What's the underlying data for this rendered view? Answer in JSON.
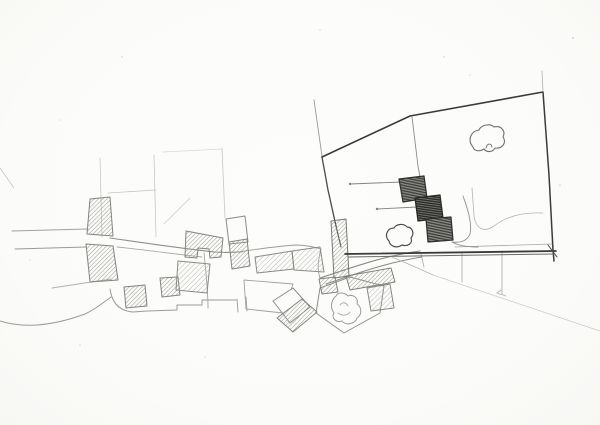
{
  "meta": {
    "description": "Hand-drawn pencil site plan sketch: a village of hatched buildings along a curving street on the left, and on the right a large plot outlined in dark pencil containing three dark stepped buildings, two trees and a bush, with faint construction lines, parcel boundaries and slope lines below."
  },
  "palette": {
    "paper": "#fcfcfa",
    "line_faint": "#c6c6c3",
    "line_light": "#a0a09c",
    "line_mid": "#82827e",
    "line_dark": "#3a3a38",
    "hatch_light_stroke": "#b6b6b1",
    "hatch_mid_stroke": "#9c9c97",
    "hatch_dark_base": "#8e8e89",
    "hatch_dark_stroke": "#3a3a37",
    "hatch_darker_base": "#75756f",
    "hatch_darker_stroke": "#2c2c2a"
  },
  "sketch": {
    "viewbox": "0 0 600 425",
    "shapes": [
      {
        "name": "construction-line-vertical-1",
        "kind": "path",
        "d": "M100,158 L102,237",
        "stroke": "#c6c6c3",
        "w": 0.8
      },
      {
        "name": "construction-line-vertical-2",
        "kind": "path",
        "d": "M154,155 L156,237",
        "stroke": "#c6c6c3",
        "w": 0.8
      },
      {
        "name": "construction-line-vertical-3",
        "kind": "path",
        "d": "M222,148 L225,218",
        "stroke": "#c6c6c3",
        "w": 0.8
      },
      {
        "name": "construction-line-horizontal",
        "kind": "path",
        "d": "M108,193 L156,190",
        "stroke": "#c6c6c3",
        "w": 0.8
      },
      {
        "name": "construction-line-top",
        "kind": "path",
        "d": "M163,152 L222,149",
        "stroke": "#d6d6d3",
        "w": 0.7
      },
      {
        "name": "construction-line-diagonal",
        "kind": "path",
        "d": "M190,198 L164,224",
        "stroke": "#cdcdca",
        "w": 0.7
      },
      {
        "name": "margin-line-left",
        "kind": "path",
        "d": "M0,168 L14,188",
        "stroke": "#c6c6c3",
        "w": 0.8
      },
      {
        "name": "road-west-upper",
        "kind": "path",
        "d": "M12,231 L88,229",
        "stroke": "#a0a09c",
        "w": 1
      },
      {
        "name": "road-west-lower",
        "kind": "path",
        "d": "M15,249 L86,247",
        "stroke": "#9a9a96",
        "w": 1
      },
      {
        "name": "road-west-branch",
        "kind": "path",
        "d": "M52,288 L111,279",
        "stroke": "#b0b0ac",
        "w": 0.9
      },
      {
        "name": "main-street",
        "kind": "path",
        "d": "M110,238 C145,243 185,249 215,252 C228,253 235,252 242,252",
        "stroke": "#8e8e89",
        "w": 1.1
      },
      {
        "name": "main-street-south-edge",
        "kind": "path",
        "d": "M117,247 C145,250 175,254 202,257",
        "stroke": "#a8a8a4",
        "w": 0.9
      },
      {
        "name": "street-past-terraces",
        "kind": "path",
        "d": "M238,252 C258,249 278,246 296,245 C306,245 314,247 321,249",
        "stroke": "#9a9a96",
        "w": 0.9
      },
      {
        "name": "lane-between-buildings",
        "kind": "path",
        "d": "M321,249 C318,260 317,269 320,278",
        "stroke": "#a0a09c",
        "w": 0.9
      },
      {
        "name": "road-climb-north-edge",
        "kind": "path",
        "d": "M320,278 C348,269 382,256 420,251",
        "stroke": "#8a8a85",
        "w": 1.1
      },
      {
        "name": "road-climb-south-edge",
        "kind": "path",
        "d": "M326,284 C352,275 388,262 422,257",
        "stroke": "#8a8a85",
        "w": 1.1
      },
      {
        "name": "lane-to-south",
        "kind": "path",
        "d": "M204,253 C206,272 208,292 208,308",
        "stroke": "#a4a4a0",
        "w": 0.9
      },
      {
        "name": "terrain-wavy-line",
        "kind": "path",
        "d": "M0,321 C25,329 55,325 85,314 C96,309 104,302 111,297",
        "stroke": "#9a9a96",
        "w": 1
      },
      {
        "name": "terrain-hook-line",
        "kind": "path",
        "d": "M110,289 C112,303 119,311 133,312 L147,311",
        "stroke": "#9a9a96",
        "w": 1
      },
      {
        "name": "parcel-step-boundary",
        "kind": "path",
        "d": "M147,311 L177,310 L177,305 L202,305 L202,300 L236,300",
        "stroke": "#9a9a96",
        "w": 1
      },
      {
        "name": "boundary-tick-1",
        "kind": "path",
        "d": "M237,299 L238,312",
        "stroke": "#9a9a96",
        "w": 0.9
      },
      {
        "name": "boundary-tick-2",
        "kind": "path",
        "d": "M246,297 L247,311",
        "stroke": "#9a9a96",
        "w": 0.9
      },
      {
        "name": "parcel-outline-left",
        "kind": "polygon",
        "points": "244,280 293,284 283,313 246,309",
        "stroke": "#a0a09c",
        "w": 0.9
      },
      {
        "name": "parcel-outline-tree",
        "kind": "polygon",
        "points": "320,288 350,277 384,286 380,313 344,333 316,313",
        "stroke": "#8e8e89",
        "w": 1
      },
      {
        "name": "slope-line-southeast",
        "kind": "path",
        "d": "M433,275 L600,331",
        "stroke": "#c8c8c5",
        "w": 0.7
      },
      {
        "name": "slope-tick-arrow",
        "kind": "path",
        "d": "M501,290 L497,293 L506,296",
        "stroke": "#b0b0ac",
        "w": 0.8
      },
      {
        "name": "fence-post-1",
        "kind": "path",
        "d": "M421,254 L424,267",
        "stroke": "#a8a8a4",
        "w": 0.8
      },
      {
        "name": "fence-post-2",
        "kind": "path",
        "d": "M462,252 L462,282",
        "stroke": "#a8a8a4",
        "w": 0.8
      },
      {
        "name": "fence-post-3",
        "kind": "path",
        "d": "M502,251 L502,294",
        "stroke": "#a8a8a4",
        "w": 0.8
      },
      {
        "name": "slope-curve-below-site",
        "kind": "path",
        "d": "M392,257 C406,263 420,269 433,275",
        "stroke": "#b4b4b0",
        "w": 0.8
      },
      {
        "name": "village-building-diamond-outline",
        "kind": "polygon",
        "points": "273,301 293,288 310,307 290,323",
        "fill": "#fcfcfa",
        "stroke": "#8a8a85",
        "w": 1
      },
      {
        "name": "village-building-diamond",
        "kind": "polygon",
        "points": "277,318 302,299 317,312 293,332",
        "fill": "hatch-mid",
        "stroke": "#82827e",
        "w": 1
      },
      {
        "name": "village-building-1",
        "kind": "polygon",
        "points": "90,199 110,197 113,236 87,234",
        "fill": "hatch-mid",
        "stroke": "#82827e",
        "w": 1
      },
      {
        "name": "village-building-2",
        "kind": "polygon",
        "points": "86,244 113,246 118,280 90,282",
        "fill": "hatch-mid",
        "stroke": "#82827e",
        "w": 1
      },
      {
        "name": "village-building-3",
        "kind": "polygon",
        "points": "124,287 145,285 147,306 126,308",
        "fill": "hatch-mid",
        "stroke": "#82827e",
        "w": 1
      },
      {
        "name": "village-building-4",
        "kind": "polygon",
        "points": "160,278 178,277 180,295 162,297",
        "fill": "hatch-mid",
        "stroke": "#82827e",
        "w": 1
      },
      {
        "name": "village-building-5",
        "kind": "polygon",
        "points": "178,261 210,264 207,293 176,290",
        "fill": "hatch-light",
        "stroke": "#8a8a85",
        "w": 1
      },
      {
        "name": "village-building-6",
        "kind": "polygon",
        "points": "186,231 223,238 221,257 210,258 209,249 198,248 197,258 185,257",
        "fill": "hatch-mid",
        "stroke": "#82827e",
        "w": 1
      },
      {
        "name": "village-building-outline-7",
        "kind": "polygon",
        "points": "226,219 245,216 248,242 229,244",
        "fill": "#fcfcfa",
        "stroke": "#8a8a85",
        "w": 1
      },
      {
        "name": "village-building-8",
        "kind": "polygon",
        "points": "229,242 247,239 250,266 232,269",
        "fill": "hatch-mid",
        "stroke": "#82827e",
        "w": 1
      },
      {
        "name": "village-building-9",
        "kind": "polygon",
        "points": "255,257 292,251 294,269 257,273",
        "fill": "hatch-light",
        "stroke": "#8a8a85",
        "w": 1
      },
      {
        "name": "village-building-10",
        "kind": "polygon",
        "points": "292,251 320,247 324,272 294,270",
        "fill": "hatch-light",
        "stroke": "#8a8a85",
        "w": 1
      },
      {
        "name": "village-building-15",
        "kind": "polygon",
        "points": "319,279 335,277 338,292 322,294",
        "fill": "hatch-mid",
        "stroke": "#82827e",
        "w": 1
      },
      {
        "name": "village-building-t-bar",
        "kind": "polygon",
        "points": "346,276 391,268 395,282 350,290",
        "fill": "hatch-mid",
        "stroke": "#82827e",
        "w": 1
      },
      {
        "name": "village-building-t-leg",
        "kind": "polygon",
        "points": "367,288 390,284 394,308 371,311",
        "fill": "hatch-light",
        "stroke": "#8a8a85",
        "w": 1
      },
      {
        "name": "site-boundary-overshoot-topleft",
        "kind": "path",
        "d": "M314,100 L322,156",
        "stroke": "#9a9a96",
        "w": 0.9
      },
      {
        "name": "site-boundary-left-upper",
        "kind": "path",
        "d": "M322,157 L328,190 L336,226",
        "stroke": "#4a4a47",
        "w": 1.3
      },
      {
        "name": "site-boundary-left-lower",
        "kind": "path",
        "d": "M336,226 L341,247",
        "stroke": "#4a4a47",
        "w": 1.1
      },
      {
        "name": "site-building-edge-strip",
        "kind": "polygon",
        "points": "331,221 346,219 349,276 334,278",
        "fill": "hatch-mid",
        "stroke": "#78786f",
        "w": 1
      },
      {
        "name": "site-boundary-top",
        "kind": "path",
        "d": "M322,157 L410,116 L543,92",
        "stroke": "#3a3a38",
        "w": 1.6
      },
      {
        "name": "site-boundary-right",
        "kind": "path",
        "d": "M543,92 L549,175 L553,250 L554,261",
        "stroke": "#3a3a38",
        "w": 1.5
      },
      {
        "name": "site-boundary-bottom",
        "kind": "path",
        "d": "M345,254 L556,251",
        "stroke": "#3a3a38",
        "w": 1.8
      },
      {
        "name": "site-boundary-bottom-inner",
        "kind": "path",
        "d": "M348,257 L554,254",
        "stroke": "#6a6a66",
        "w": 1
      },
      {
        "name": "site-boundary-bottom-light",
        "kind": "path",
        "d": "M455,247 L552,244",
        "stroke": "#a8a8a4",
        "w": 0.8
      },
      {
        "name": "site-corner-cross",
        "kind": "path",
        "d": "M548,245 L557,257",
        "stroke": "#4a4a47",
        "w": 1
      },
      {
        "name": "site-boundary-overshoot-topright",
        "kind": "path",
        "d": "M543,92 L542,71",
        "stroke": "#b0b0ac",
        "w": 0.8
      },
      {
        "name": "site-internal-line",
        "kind": "path",
        "d": "M412,117 L418,166 L420,177",
        "stroke": "#8a8a85",
        "w": 0.9
      },
      {
        "name": "site-leader-line-1",
        "kind": "path",
        "d": "M350,184 L401,182",
        "stroke": "#82827e",
        "w": 0.9
      },
      {
        "name": "site-leader-dot-1",
        "kind": "circle",
        "cx": 350,
        "cy": 184,
        "r": 1.2,
        "fill": "#82827e"
      },
      {
        "name": "site-leader-line-2",
        "kind": "path",
        "d": "M377,209 L417,207",
        "stroke": "#82827e",
        "w": 0.9
      },
      {
        "name": "site-leader-dot-2",
        "kind": "circle",
        "cx": 377,
        "cy": 209,
        "r": 1.2,
        "fill": "#82827e"
      },
      {
        "name": "site-path-curve",
        "kind": "path",
        "d": "M463,196 C469,212 472,226 470,234 C467,241 460,243 452,242 C459,246 468,247 478,247",
        "stroke": "#8e8e89",
        "w": 0.9
      },
      {
        "name": "site-path-right",
        "kind": "path",
        "d": "M472,188 L474,216 C476,229 484,233 494,226 C507,216 524,212 543,213",
        "stroke": "#b4b4b0",
        "w": 0.8
      },
      {
        "name": "proposed-building-1",
        "kind": "polygon",
        "points": "399,179 424,176 427,198 403,202",
        "fill": "hatch-dark",
        "stroke": "#2e2e2c",
        "w": 1.2
      },
      {
        "name": "proposed-building-2",
        "kind": "polygon",
        "points": "415,198 440,195 443,218 418,221",
        "fill": "hatch-darker",
        "stroke": "#262624",
        "w": 1.2
      },
      {
        "name": "proposed-building-3",
        "kind": "polygon",
        "points": "426,219 451,217 453,240 428,242",
        "fill": "hatch-dark",
        "stroke": "#2e2e2c",
        "w": 1.2
      },
      {
        "name": "tree-site",
        "kind": "path",
        "d": "M473,147 C467,140 471,131 479,130 C481,125 490,123 494,127 C501,125 506,131 503,137 C507,143 502,149 495,148 C493,152 487,153 484,149 C479,152 474,151 473,147 Z",
        "stroke": "#6f6f6b",
        "w": 1.1
      },
      {
        "name": "tree-site-inner-mark",
        "kind": "path",
        "d": "M486,148 C487,143 491,143 492,147",
        "stroke": "#6f6f6b",
        "w": 0.9
      },
      {
        "name": "bush-site",
        "kind": "path",
        "d": "M389,241 C384,236 387,228 394,228 C396,224 404,223 407,227 C412,227 415,233 411,238 C413,243 408,247 402,245 C396,249 390,246 389,241 Z",
        "fill": "#fcfcfa",
        "stroke": "#4e4e4a",
        "w": 1.2
      },
      {
        "name": "tree-village",
        "kind": "path",
        "d": "M336,296 C331,300 330,308 334,313 C331,318 336,323 342,321 C346,326 355,324 357,318 C362,315 362,307 357,304 C359,298 353,294 348,296 C344,292 338,292 336,296 Z",
        "stroke": "#9a9a96",
        "w": 1
      },
      {
        "name": "tree-village-inner-1",
        "kind": "path",
        "d": "M340,305 C342,302 346,302 348,306",
        "stroke": "#aaaaa6",
        "w": 0.9
      },
      {
        "name": "tree-village-inner-2",
        "kind": "path",
        "d": "M338,313 C342,316 347,316 350,312",
        "stroke": "#aaaaa6",
        "w": 0.9
      },
      {
        "name": "paper-speck-1",
        "kind": "circle",
        "cx": 573,
        "cy": 38,
        "r": 1,
        "fill": "#d8d8d5"
      },
      {
        "name": "paper-speck-2",
        "kind": "circle",
        "cx": 444,
        "cy": 57,
        "r": 0.9,
        "fill": "#dcdcd9"
      },
      {
        "name": "paper-speck-3",
        "kind": "circle",
        "cx": 320,
        "cy": 30,
        "r": 0.8,
        "fill": "#dcdcd9"
      },
      {
        "name": "paper-speck-4",
        "kind": "circle",
        "cx": 122,
        "cy": 57,
        "r": 0.9,
        "fill": "#dcdcd9"
      },
      {
        "name": "paper-speck-5",
        "kind": "circle",
        "cx": 60,
        "cy": 120,
        "r": 0.8,
        "fill": "#e0e0dd"
      },
      {
        "name": "paper-speck-6",
        "kind": "circle",
        "cx": 560,
        "cy": 185,
        "r": 0.9,
        "fill": "#dcdcd9"
      },
      {
        "name": "paper-speck-7",
        "kind": "circle",
        "cx": 80,
        "cy": 345,
        "r": 0.9,
        "fill": "#e0e0dd"
      },
      {
        "name": "paper-speck-8",
        "kind": "circle",
        "cx": 205,
        "cy": 357,
        "r": 0.8,
        "fill": "#e0e0dd"
      },
      {
        "name": "paper-speck-9",
        "kind": "circle",
        "cx": 470,
        "cy": 75,
        "r": 0.8,
        "fill": "#e0e0dd"
      },
      {
        "name": "paper-speck-10",
        "kind": "circle",
        "cx": 30,
        "cy": 260,
        "r": 0.8,
        "fill": "#e0e0dd"
      }
    ]
  }
}
